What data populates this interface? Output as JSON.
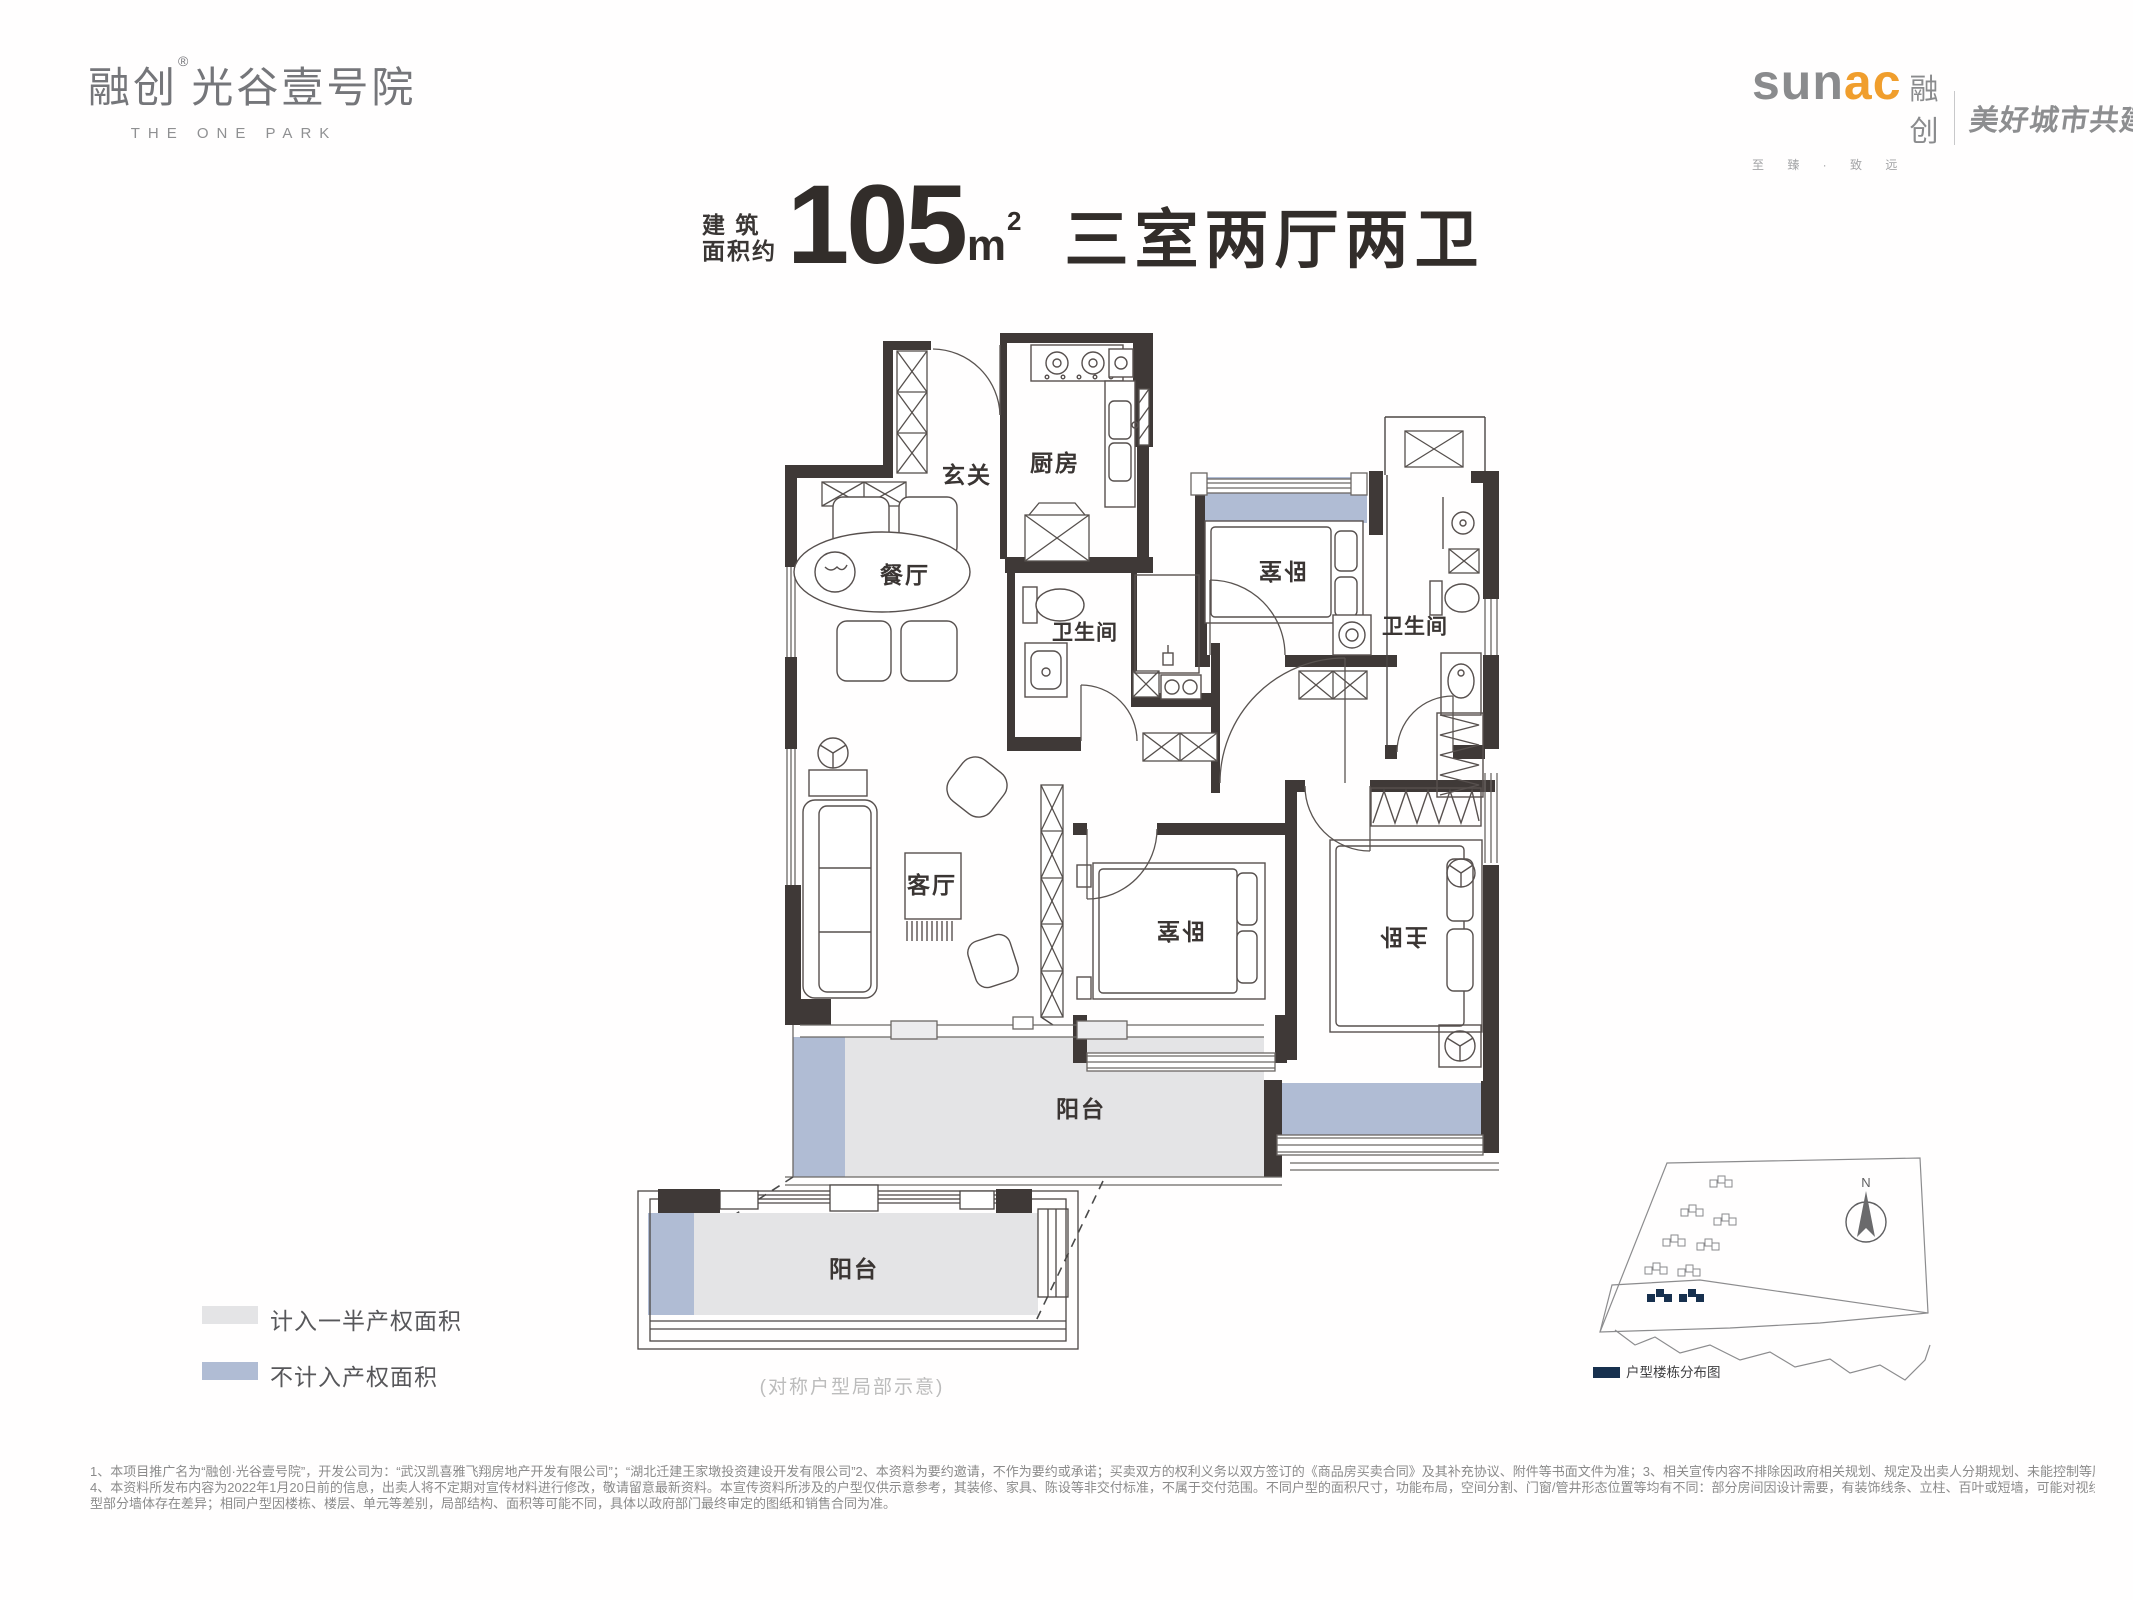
{
  "header": {
    "logo": {
      "brand": "融创",
      "reg": "®",
      "project": "光谷壹号院",
      "subtitle": "THE ONE PARK"
    },
    "sunac": {
      "latin_gray": "sun",
      "latin_orange": "ac",
      "cn": "融创",
      "slogan": "至 臻 · 致 远",
      "tagline": "美好城市共建者",
      "accent_color": "#f09e2d"
    }
  },
  "title": {
    "prefix_line1": "建 筑",
    "prefix_line2": "面积约",
    "area_value": "105",
    "area_unit": "m",
    "area_exponent": "2",
    "layout": "三室两厅两卫"
  },
  "floorplan": {
    "labels": {
      "foyer": "玄关",
      "kitchen": "厨房",
      "dining": "餐厅",
      "living": "客厅",
      "bathroom": "卫生间",
      "bathroom2": "卫生间",
      "bedroom": "卧室",
      "bedroom2": "卧室",
      "master": "主卧",
      "balcony": "阳台",
      "balcony_detail": "阳台"
    },
    "caption": "(对称户型局部示意)",
    "colors": {
      "wall": "#3f3937",
      "half_area_fill": "#e4e4e6",
      "excluded_fill": "#b0bcd4"
    }
  },
  "legend": {
    "items": [
      {
        "label": "计入一半产权面积",
        "color": "#e4e4e6"
      },
      {
        "label": "不计入产权面积",
        "color": "#b0bcd4"
      }
    ]
  },
  "siteplan": {
    "north": "N",
    "legend_label": "户型楼栋分布图",
    "highlight_color": "#17304e"
  },
  "disclaimer": {
    "line1": "1、本项目推广名为“融创·光谷壹号院”，开发公司为：“武汉凯喜雅飞翔房地产开发有限公司”；“湖北迁建王家墩投资建设开发有限公司”2、本资料为要约邀请，不作为要约或承诺；买卖双方的权利义务以双方签订的《商品房买卖合同》及其补充协议、附件等书面文件为准；3、相关宣传内容不排除因政府相关规划、规定及出卖人分期规划、未能控制等原因发生变化；",
    "line2": "4、本资料所发布内容为2022年1月20日前的信息，出卖人将不定期对宣传材料进行修改，敬请留意最新资料。本宣传资料所涉及的户型仅供示意参考，其装修、家具、陈设等非交付标准，不属于交付范围。不同户型的面积尺寸，功能布局，空间分割、门窗/管井形态位置等均有不同：部分房间因设计需要，有装饰线条、立柱、百叶或短墙，可能对视线有遮挡：对称户",
    "line3": "型部分墙体存在差异；相同户型因楼栋、楼层、单元等差别，局部结构、面积等可能不同，具体以政府部门最终审定的图纸和销售合同为准。"
  }
}
